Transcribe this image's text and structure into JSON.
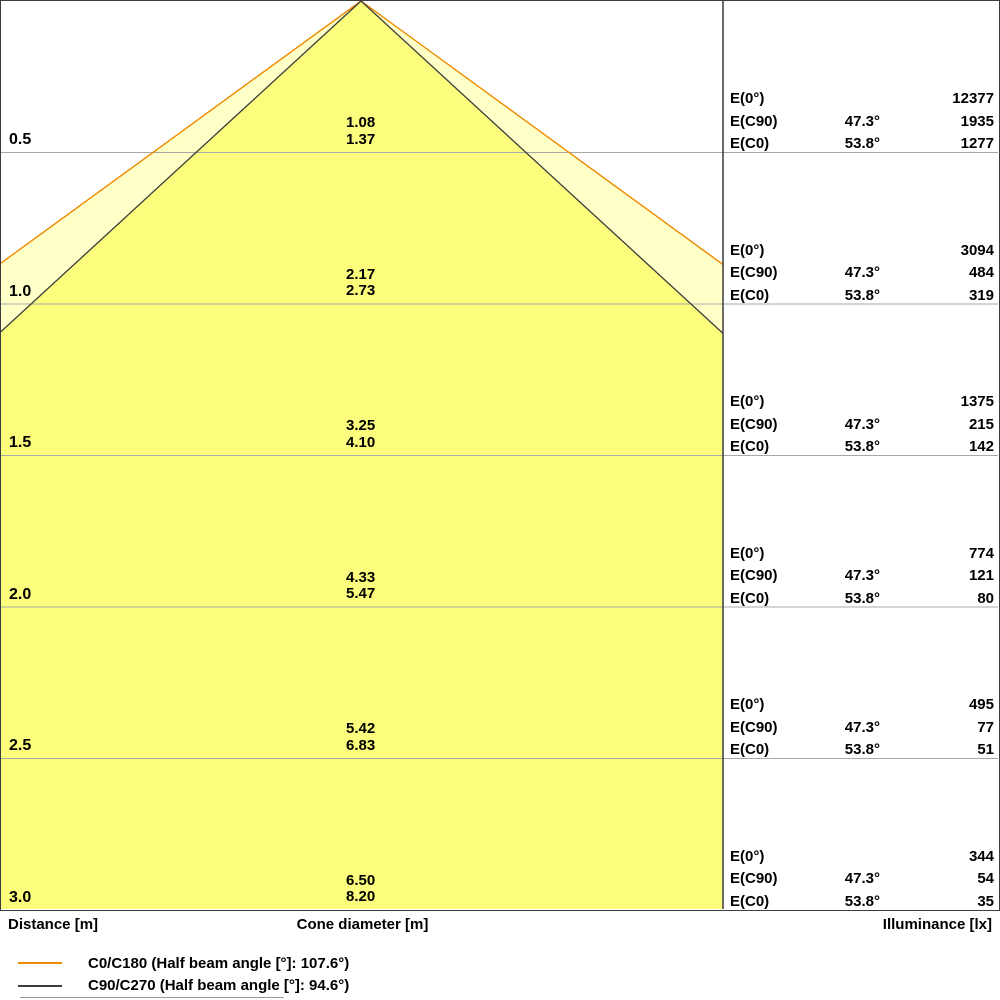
{
  "chart_data": {
    "type": "table",
    "title": "Luminous cone diagram (distance vs cone diameter and illuminance)",
    "y_axis": {
      "label": "Distance [m]",
      "values": [
        0.5,
        1.0,
        1.5,
        2.0,
        2.5,
        3.0
      ]
    },
    "x_label": "Cone diameter [m]",
    "value_label": "Illuminance [lx]",
    "series": [
      {
        "name": "C0/C180",
        "half_beam_angle_deg": 107.6,
        "half_angle_deg": 53.8,
        "cone_diameters_m": [
          1.37,
          2.73,
          4.1,
          5.47,
          6.83,
          8.2
        ],
        "color": "#ed8b00"
      },
      {
        "name": "C90/C270",
        "half_beam_angle_deg": 94.6,
        "half_angle_deg": 47.3,
        "cone_diameters_m": [
          1.08,
          2.17,
          3.25,
          4.33,
          5.42,
          6.5
        ],
        "color": "#3c3c3c"
      }
    ],
    "illuminance_lx": {
      "E(0deg)": [
        12377,
        3094,
        1375,
        774,
        495,
        344
      ],
      "E(C90)": {
        "angle": "47.3°",
        "values": [
          1935,
          484,
          215,
          121,
          77,
          54
        ]
      },
      "E(C0)": {
        "angle": "53.8°",
        "values": [
          1277,
          319,
          142,
          80,
          51,
          35
        ]
      }
    }
  },
  "e_labels": {
    "e0": "E(0°)",
    "ec90": "E(C90)",
    "ec0": "E(C0)"
  },
  "rows": [
    {
      "distance": "0.5",
      "cone_c90": "1.08",
      "cone_c0": "1.37",
      "e0": "12377",
      "ec90_angle": "47.3°",
      "ec90": "1935",
      "ec0_angle": "53.8°",
      "ec0": "1277"
    },
    {
      "distance": "1.0",
      "cone_c90": "2.17",
      "cone_c0": "2.73",
      "e0": "3094",
      "ec90_angle": "47.3°",
      "ec90": "484",
      "ec0_angle": "53.8°",
      "ec0": "319"
    },
    {
      "distance": "1.5",
      "cone_c90": "3.25",
      "cone_c0": "4.10",
      "e0": "1375",
      "ec90_angle": "47.3°",
      "ec90": "215",
      "ec0_angle": "53.8°",
      "ec0": "142"
    },
    {
      "distance": "2.0",
      "cone_c90": "4.33",
      "cone_c0": "5.47",
      "e0": "774",
      "ec90_angle": "47.3°",
      "ec90": "121",
      "ec0_angle": "53.8°",
      "ec0": "80"
    },
    {
      "distance": "2.5",
      "cone_c90": "5.42",
      "cone_c0": "6.83",
      "e0": "495",
      "ec90_angle": "47.3°",
      "ec90": "77",
      "ec0_angle": "53.8°",
      "ec0": "51"
    },
    {
      "distance": "3.0",
      "cone_c90": "6.50",
      "cone_c0": "8.20",
      "e0": "344",
      "ec90_angle": "47.3°",
      "ec90": "54",
      "ec0_angle": "53.8°",
      "ec0": "35"
    }
  ],
  "footer": {
    "distance_label": "Distance [m]",
    "cone_label": "Cone diameter [m]",
    "illuminance_label": "Illuminance [lx]"
  },
  "legend": [
    {
      "label": "C0/C180 (Half beam angle [°]: 107.6°)",
      "color": "#ed8b00"
    },
    {
      "label": "C90/C270 (Half beam angle [°]: 94.6°)",
      "color": "#3c3c3c"
    }
  ],
  "colors": {
    "cone_outer_fill": "#ffffc8",
    "cone_inner_fill": "#fcfc7d",
    "c0_line": "#ed8b00",
    "c90_line": "#3c3c3c",
    "grid": "#a8a8a8",
    "frame": "#3c3c3c"
  }
}
